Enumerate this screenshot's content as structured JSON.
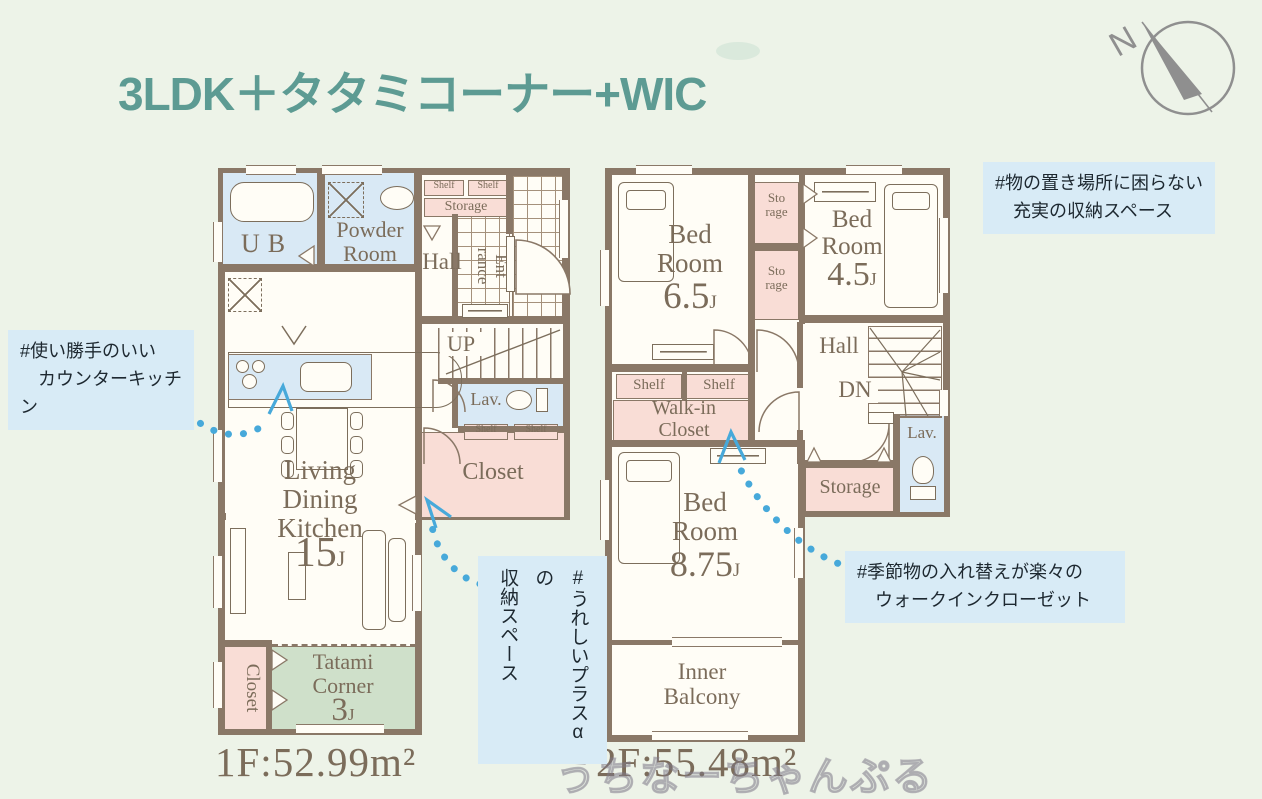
{
  "title": "3LDK＋タタミコーナー+WIC",
  "compass": {
    "north": "N"
  },
  "watermark": "うちなーちゃんぷる",
  "floor1": {
    "area": "1F:52.99m²",
    "labels": {
      "ub": "UB",
      "powder": "Powder\nRoom",
      "shelf": "Shelf",
      "storage": "Storage",
      "hall": "Hall",
      "entrance": "Ent\nrance",
      "up": "UP",
      "lav": "Lav.",
      "closet": "Closet",
      "ldk": "Living\nDining\nKitchen",
      "ldk_size": "15",
      "tatami": "Tatami\nCorner",
      "tatami_size": "3",
      "closet_side": "Closet",
      "unit": "J"
    }
  },
  "floor2": {
    "area": "2F:55.48m²",
    "labels": {
      "bed": "Bed\nRoom",
      "bed1_size": "6.5",
      "bed2_size": "4.5",
      "bed3_size": "8.75",
      "storage_v": "Sto\nrage",
      "storage": "Storage",
      "hall": "Hall",
      "dn": "DN",
      "shelf": "Shelf",
      "wic": "Walk-in\nCloset",
      "lav": "Lav.",
      "balcony": "Inner\nBalcony",
      "unit": "J"
    }
  },
  "annotations": {
    "kitchen": "#使い勝手のいい\n　カウンターキッチン",
    "storage": "#物の置き場所に困らない\n　充実の収納スペース",
    "plus": "#うれしいプラスαの\n収納スペース",
    "wic": "#季節物の入れ替えが楽々の\n　ウォークインクローゼット"
  },
  "colors": {
    "wall": "#8a7867",
    "wet": "#d9e9f5",
    "closet_pink": "#f9ddd6",
    "tatami_green": "#cfe0ca",
    "note_blue": "#d8ebf6",
    "arrow_blue": "#47a9da",
    "title_teal": "#5d9b93",
    "text_brown": "#7b6c5a"
  }
}
